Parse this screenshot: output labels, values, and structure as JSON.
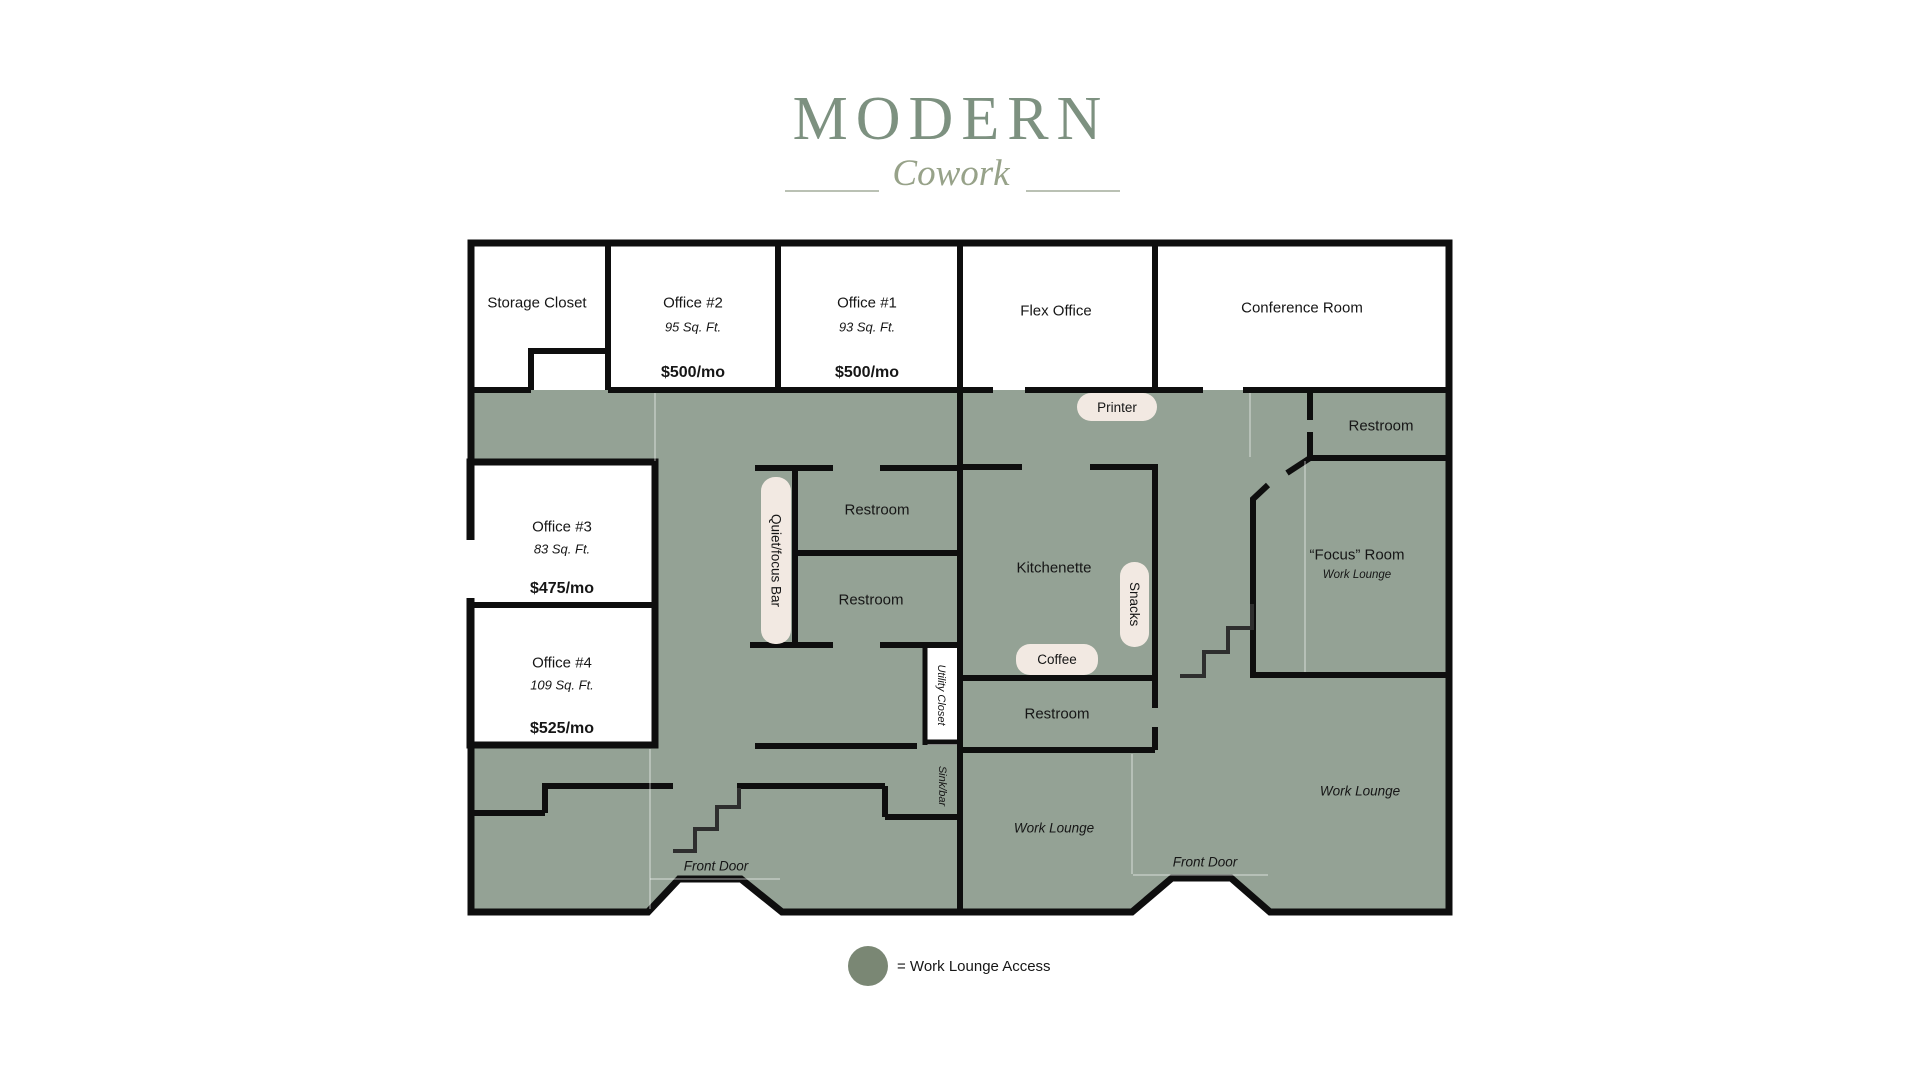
{
  "logo": {
    "title": "MODERN",
    "subtitle": "Cowork"
  },
  "rooms": {
    "storage_closet": {
      "label": "Storage Closet"
    },
    "office2": {
      "label": "Office #2",
      "area": "95 Sq. Ft.",
      "price": "$500/mo"
    },
    "office1": {
      "label": "Office #1",
      "area": "93 Sq. Ft.",
      "price": "$500/mo"
    },
    "flex_office": {
      "label": "Flex Office"
    },
    "conference_room": {
      "label": "Conference Room"
    },
    "office3": {
      "label": "Office #3",
      "area": "83 Sq. Ft.",
      "price": "$475/mo"
    },
    "office4": {
      "label": "Office #4",
      "area": "109 Sq. Ft.",
      "price": "$525/mo"
    },
    "restroom_upper_mid": {
      "label": "Restroom"
    },
    "restroom_lower_mid": {
      "label": "Restroom"
    },
    "kitchenette": {
      "label": "Kitchenette"
    },
    "restroom_kitchen": {
      "label": "Restroom"
    },
    "restroom_top_right": {
      "label": "Restroom"
    },
    "focus_room": {
      "label": "“Focus” Room",
      "sublabel": "Work Lounge"
    },
    "work_lounge_mid": {
      "label": "Work Lounge"
    },
    "work_lounge_right": {
      "label": "Work Lounge"
    }
  },
  "amenities": {
    "printer": {
      "label": "Printer"
    },
    "coffee": {
      "label": "Coffee"
    },
    "snacks": {
      "label": "Snacks"
    },
    "quiet_focus_bar": {
      "label": "Quiet/focus Bar"
    },
    "utility_closet": {
      "label": "Utility Closet"
    },
    "sink_bar": {
      "label": "Sink/bar"
    },
    "front_door_left": {
      "label": "Front Door"
    },
    "front_door_right": {
      "label": "Front Door"
    }
  },
  "legend": {
    "label": "= Work Lounge Access"
  },
  "colors": {
    "floor": "#94a295",
    "pill": "#f2e9e2",
    "legend_circle": "#7a8774",
    "logo_main": "#7d9180",
    "logo_script": "#97a289",
    "logo_line": "#bac1b4",
    "wall": "#0e0e0e",
    "ink": "#161616"
  }
}
